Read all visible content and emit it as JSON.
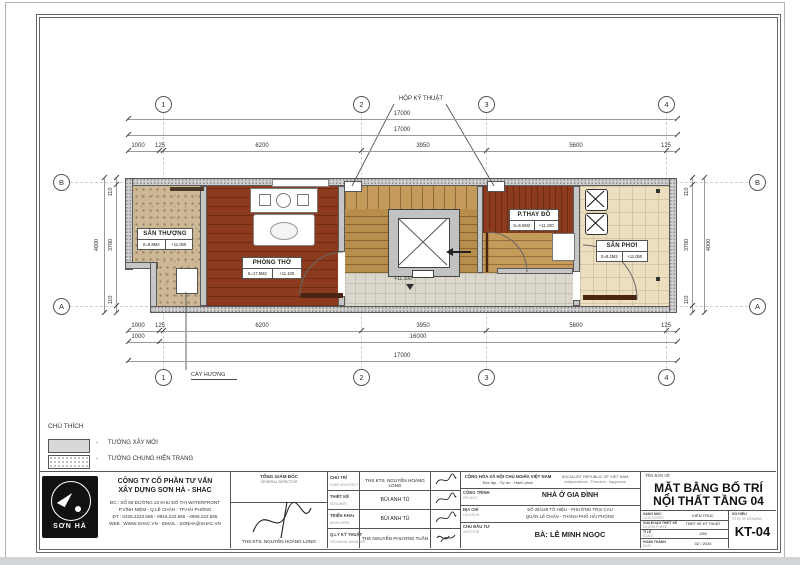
{
  "plan": {
    "grid": {
      "cols": [
        "1",
        "2",
        "3",
        "4"
      ],
      "rows": [
        "B",
        "A"
      ]
    },
    "callouts": {
      "tech_box": "HỘP KỸ THUẬT",
      "incense": "CÂY HƯƠNG"
    },
    "dims": {
      "top_total_a": "17000",
      "top_total_b": "17000",
      "top_segments": [
        "1000",
        "125",
        "6200",
        "3950",
        "5600",
        "125"
      ],
      "bottom_segments": [
        "1000",
        "125",
        "6200",
        "3950",
        "5600",
        "125"
      ],
      "bottom_left": "1000",
      "bottom_inner": "16000",
      "bottom_total": "17000",
      "side": [
        "110",
        "3780",
        "110"
      ],
      "side_total": "4000"
    },
    "rooms": {
      "san_thuong": {
        "name": "SÂN THƯỢNG",
        "area": "S=6.8M2",
        "level": "+11.050"
      },
      "phong_tho": {
        "name": "PHÒNG THỜ",
        "area": "S=17.5M2",
        "level": "+11.100"
      },
      "p_thay_do": {
        "name": "P.THAY ĐỒ",
        "area": "S=6.0M2",
        "level": "+11.100"
      },
      "san_phoi": {
        "name": "SÂN PHƠI",
        "area": "S=8.2M2",
        "level": "+11.050"
      },
      "corridor": {
        "level": "+11.100"
      }
    }
  },
  "legend": {
    "title": "CHÚ THÍCH",
    "separator": "-",
    "items": [
      {
        "label": "TƯỜNG XÂY MỚI"
      },
      {
        "label": "TƯỜNG CHUNG HIỆN TRẠNG"
      }
    ]
  },
  "title_block": {
    "company": {
      "logo_text": "SƠN HÀ",
      "name_line1": "CÔNG TY CỔ PHẦN TƯ VẤN",
      "name_line2": "XÂY DỰNG SƠN HÀ - SHAC",
      "address1": "ĐC : SỐ 55 ĐƯỜNG 22 KHU ĐÔ THỊ WATERFRONT",
      "address2": "P.VĨNH NIỆM - Q.LÊ CHÂN - TP.HẢI PHÒNG",
      "phone": "ĐT : 0225.2222.555 - 0916.222.555 - 0906.222.555",
      "web": "WEB : WWW.SHAC.VN - EMAIL : SONHA@SHAC.VN"
    },
    "director": {
      "title_vn": "TỔNG GIÁM ĐỐC",
      "title_en": "GENERAL DIRECTOR",
      "name": "THS.KTS. NGUYỄN HOÀNG LONG"
    },
    "roles": [
      {
        "label": "CHỦ TRÌ",
        "label_en": "CHIEF ARCHITECT",
        "name": "THS.KTS. NGUYỄN HOÀNG LONG"
      },
      {
        "label": "THIẾT KẾ",
        "label_en": "DESIGNER",
        "name": "BÙI ANH TÚ"
      },
      {
        "label": "TRIỂN KHAI",
        "label_en": "DEVELOPED",
        "name": "BÙI ANH TÚ"
      },
      {
        "label": "Q.LÝ KỸ THUẬT",
        "label_en": "TECHNICAL MANAGER",
        "name": "THS NGUYỄN PHƯƠNG TUẤN"
      }
    ],
    "republic": {
      "vn1": "CỘNG HÒA XÃ HỘI CHỦ NGHĨA VIỆT NAM",
      "vn2": "Độc lập - Tự do - Hạnh phúc",
      "en1": "SOCIALIST REPUBLIC OF VIET NAM",
      "en2": "Independence - Freedom - happiness"
    },
    "project": {
      "label": "CÔNG TRÌNH",
      "label_en": "PROJECT",
      "value": "NHÀ Ở GIA ĐÌNH"
    },
    "location": {
      "label": "ĐỊA CHỈ",
      "label_en": "LOCATION",
      "line1": "SỐ 26/125 TÔ HIỆU - PHƯỜNG TRẠI CAU",
      "line2": "QUẬN LÊ CHÂN - THÀNH PHỐ HẢI PHÒNG"
    },
    "investor": {
      "label": "CHỦ ĐẦU TƯ",
      "label_en": "INVESTOR",
      "value": "BÀ: LÊ MINH NGỌC"
    },
    "drawing": {
      "label": "TÊN BẢN VẼ",
      "title_line1": "MẶT BẰNG BỐ TRÍ",
      "title_line2": "NỘI THẤT TẦNG 04",
      "rows": [
        {
          "label": "HẠNG MỤC",
          "label_en": "CATEGORIES",
          "value": "KIẾN TRÚC"
        },
        {
          "label": "GIAI ĐOẠN THIẾT KẾ",
          "label_en": "DESIGN PHASE",
          "value": "THIẾT KẾ KỸ THUẬT"
        },
        {
          "label": "TỈ LỆ",
          "label_en": "SCALE",
          "value": "1/50"
        },
        {
          "label": "HOÀN THÀNH",
          "label_en": "DATE",
          "value": "02 / 2024"
        }
      ],
      "number_label": "SỐ HIỆU",
      "number_label_en": "TITLE OF DRAWING",
      "number": "KT-04"
    }
  }
}
